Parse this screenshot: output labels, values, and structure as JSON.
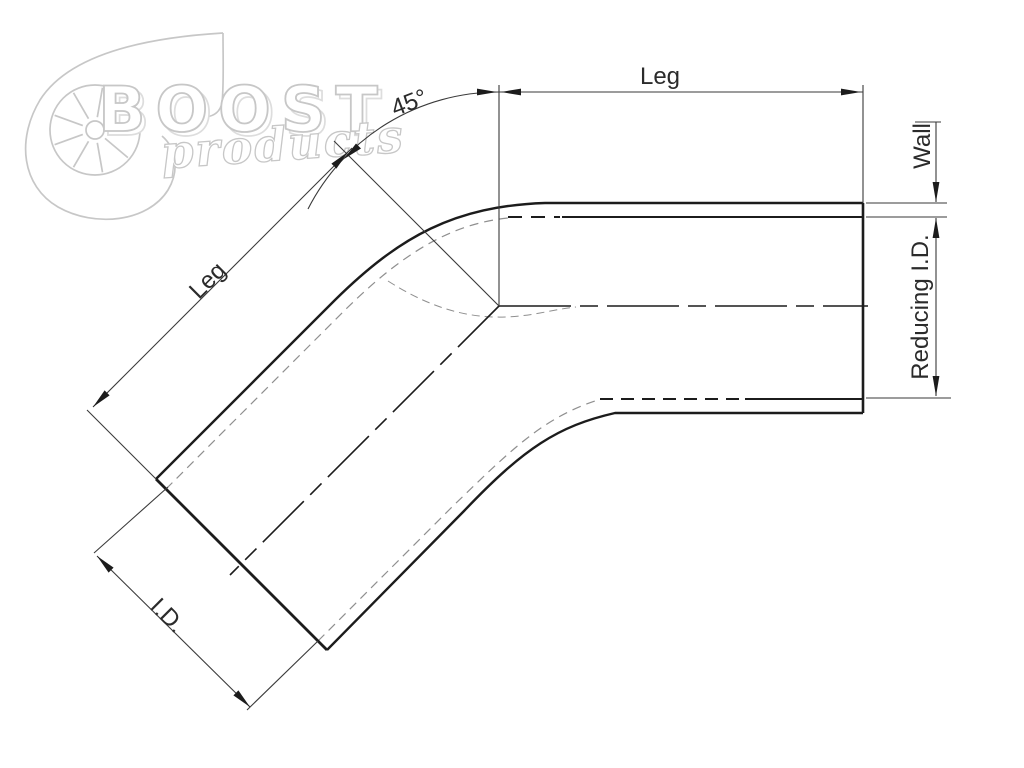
{
  "title": "45 degree reducing elbow dimension drawing",
  "watermark": {
    "brand": "BOOST",
    "sub": "products"
  },
  "labels": {
    "leg_top": "Leg",
    "leg_diagonal": "Leg",
    "angle": "45°",
    "wall": "Wall",
    "reducing_id": "Reducing I.D.",
    "inner_diameter": "I.D."
  },
  "colors": {
    "background": "#ffffff",
    "outline": "#1c1c1c",
    "dimension": "#3a3a3a",
    "hidden": "#8f8f8f",
    "watermark": "#c7c7c7",
    "watermark_shadow": "#dddddd",
    "text": "#2b2b2b"
  }
}
